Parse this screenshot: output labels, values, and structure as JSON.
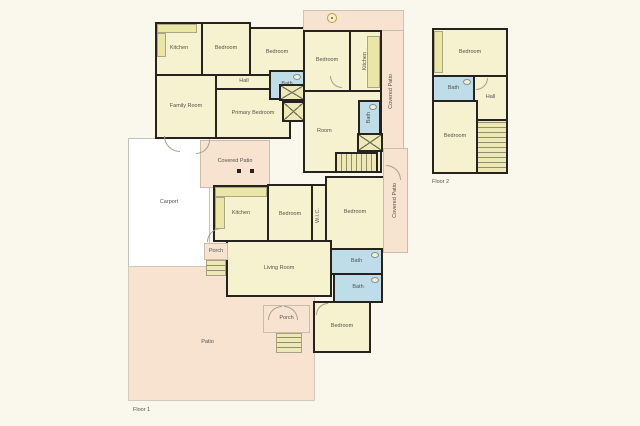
{
  "plan_type": "residential-floor-plan",
  "floor_labels": {
    "floor1": "Floor 1",
    "floor2": "Floor 2"
  },
  "rooms": {
    "a_kitchen": "Kitchen",
    "a_bedroom1": "Bedroom",
    "a_bedroom2": "Bedroom",
    "a_hall": "Hall",
    "a_family": "Family Room",
    "a_primary": "Primary Bedroom",
    "a_bath": "Bath",
    "b_bedroom": "Bedroom",
    "b_kitchen": "Kitchen",
    "b_bath": "Bath",
    "b_room": "Room",
    "b_covered_patio": "Covered Patio",
    "f2_bedroom_top": "Bedroom",
    "f2_bath": "Bath",
    "f2_hall": "Hall",
    "f2_bedroom_bottom": "Bedroom",
    "c_covered_patio": "Covered Patio",
    "c_kitchen": "Kitchen",
    "c_bedroom_left": "Bedroom",
    "c_wic": "W.I.C.",
    "c_bedroom_right": "Bedroom",
    "c_bath_upper": "Bath",
    "c_bath_lower": "Bath",
    "c_living": "Living Room",
    "c_porch_side": "Porch",
    "c_porch_front": "Porch",
    "c_bedroom_bottom": "Bedroom",
    "c_covered_patio_side": "Covered Patio",
    "carport": "Carport",
    "patio": "Patio"
  },
  "colors": {
    "background": "#faf7ec",
    "room_floor": "#f6f1cf",
    "patio_floor": "#f8e3d1",
    "bath_floor": "#bfdde9",
    "counter": "#e9e6a6",
    "wall": "#26231e",
    "carport": "#ffffff"
  }
}
